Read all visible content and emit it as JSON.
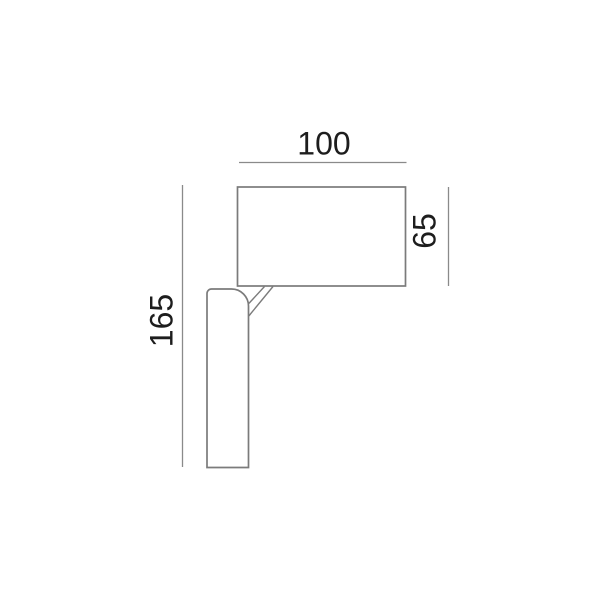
{
  "drawing": {
    "labels": {
      "width": "100",
      "total_height": "165",
      "head_height": "65"
    },
    "colors": {
      "outline": "#7b7b7b",
      "dimension_line": "#8a8a8a",
      "text": "#1d1d1d",
      "background": "#ffffff"
    }
  }
}
